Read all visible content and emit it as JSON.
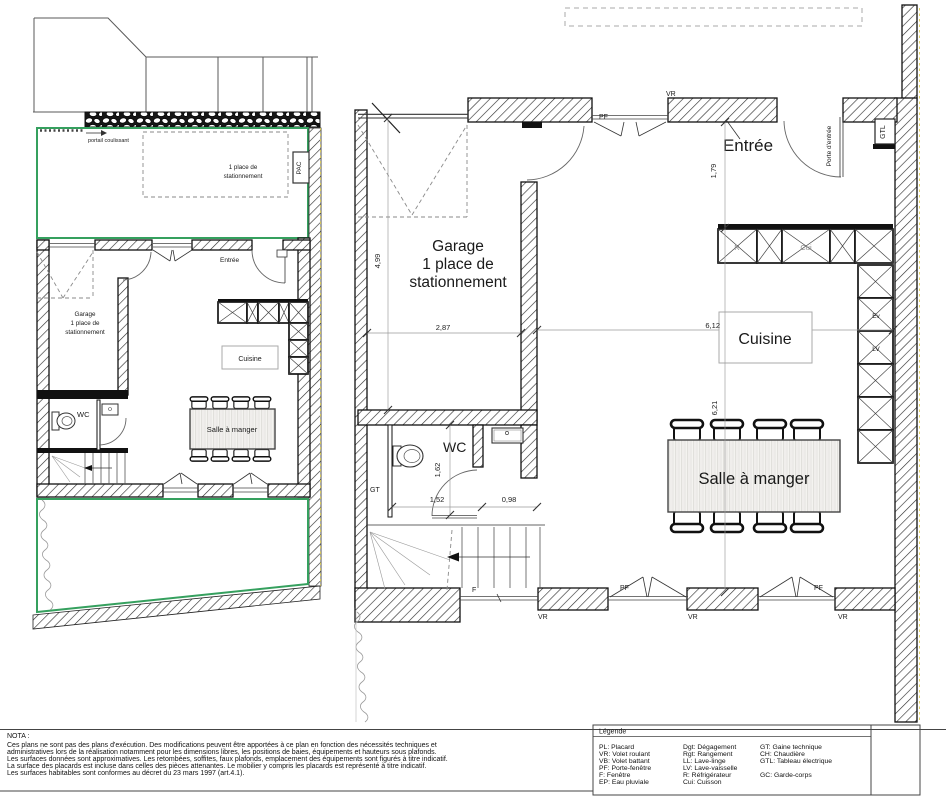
{
  "site_plan": {
    "portail_label": "portail coulissant",
    "parking_line1": "1 place de",
    "parking_line2": "stationnement",
    "pac_label": "PAC",
    "entree_label": "Entrée",
    "garage_line1": "Garage",
    "garage_line2": "1 place de",
    "garage_line3": "stationnement",
    "cuisine_label": "Cuisine",
    "wc_label": "WC",
    "salle_label": "Salle à manger"
  },
  "floor_plan": {
    "rooms": {
      "garage_line1": "Garage",
      "garage_line2": "1 place de",
      "garage_line3": "stationnement",
      "entree": "Entrée",
      "wc": "WC",
      "cuisine": "Cuisine",
      "salle": "Salle à manger"
    },
    "labels": {
      "vr": "VR",
      "pf": "PF",
      "f": "F",
      "gt": "GT",
      "gtl": "GTL",
      "porte_entree": "Porte d'entrée",
      "r": "R",
      "cui": "Cui",
      "ev": "Ev",
      "lv": "LV"
    },
    "dimensions": {
      "garage_depth": "4,99",
      "garage_width": "2,87",
      "entree_depth": "1,79",
      "sejour_width": "6,12",
      "sejour_depth": "6,21",
      "wc_depth": "1,62",
      "wc_width": "1,52",
      "degagement_width": "0,98"
    }
  },
  "nota": {
    "title": "NOTA :",
    "lines": [
      "Ces plans ne sont pas des plans d'exécution. Des modifications peuvent être apportées à ce plan en fonction des nécessités techniques et",
      "administratives lors de la réalisation notamment pour les dimensions libres, les positions de baies, équipements et hauteurs sous plafonds.",
      "Les surfaces données sont approximatives. Les retombées, soffites, faux plafonds, emplacement des équipements sont figurés à titre indicatif.",
      "La surface des placards est incluse dans celles des pièces attenantes. Le mobilier y compris les placards est représenté à titre indicatif.",
      "Les surfaces habitables sont conformes au décret du 23 mars 1997 (art.4.1)."
    ]
  },
  "legend": {
    "title": "Légende",
    "col1": [
      "PL: Placard",
      "VR: Volet roulant",
      "VB: Volet battant",
      "PF: Porte-fenêtre",
      "F: Fenêtre",
      "EP: Eau pluviale"
    ],
    "col2": [
      "Dgt: Dégagement",
      "Rgt: Rangement",
      "LL: Lave-linge",
      "LV: Lave-vaisselle",
      "R: Réfrigérateur",
      "Cui: Cuisson"
    ],
    "col3": [
      "GT: Gaine technique",
      "CH: Chaudière",
      "GTL: Tableau électrique",
      "GC: Garde-corps"
    ]
  }
}
